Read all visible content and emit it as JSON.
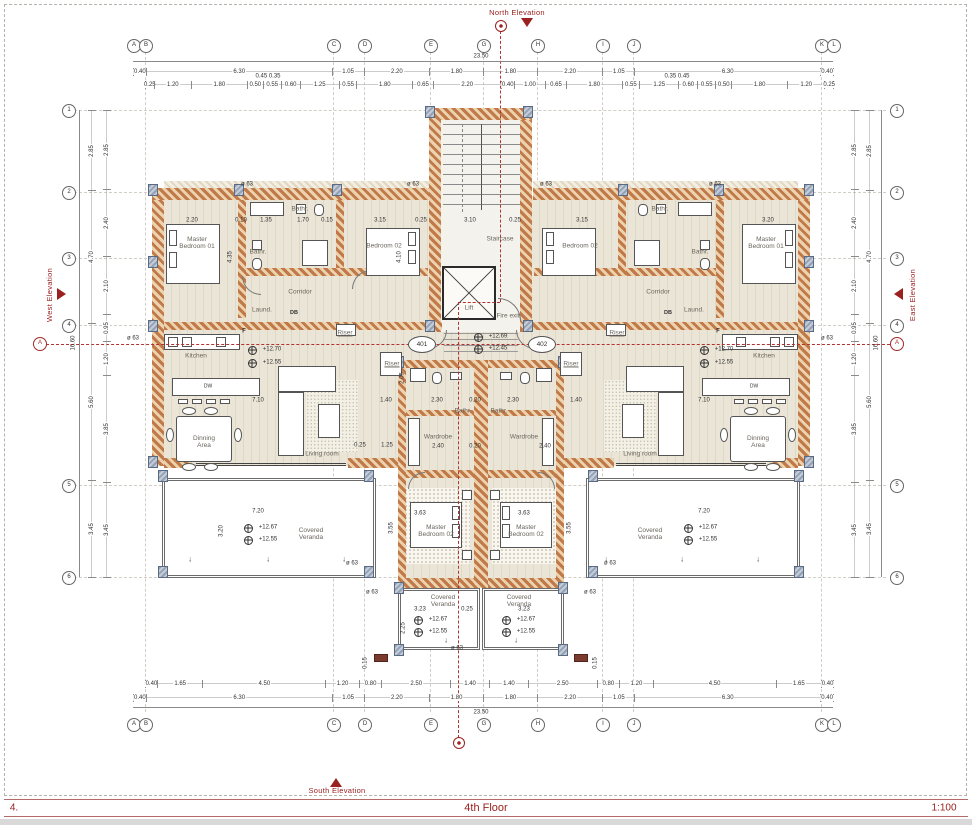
{
  "sheet": {
    "number": "4.",
    "title": "4th Floor",
    "scale": "1:100"
  },
  "elevations": {
    "north": "North Elevation",
    "south": "South Elevation",
    "east": "East Elevation",
    "west": "West Elevation"
  },
  "grid": {
    "cols": [
      "A",
      "B",
      "C",
      "D",
      "E",
      "G",
      "H",
      "I",
      "J",
      "K",
      "L"
    ],
    "rows": [
      "1",
      "2",
      "3",
      "4",
      "5",
      "6"
    ],
    "section_marker": "A"
  },
  "totals": {
    "width": "23.50",
    "height": "16.60"
  },
  "dim_rows": {
    "top_major": [
      "0.40",
      "6.30",
      "1.05",
      "2.20",
      "1.80",
      "1.80",
      "2.20",
      "1.05",
      "6.30",
      "0.40"
    ],
    "top_detail": [
      "0.25",
      "1.20",
      "1.80",
      "0.50",
      "0.55",
      "0.60",
      "1.25",
      "0.55",
      "1.80",
      "0.65",
      "2.20",
      "0.40",
      "1.00",
      "0.65",
      "1.80",
      "0.55",
      "1.25",
      "0.60",
      "0.55",
      "0.50",
      "1.80",
      "1.20",
      "0.25"
    ],
    "top_floaters": [
      "0.45 0.35",
      "0.35 0.45"
    ],
    "bottom_major": [
      "0.40",
      "6.30",
      "1.05",
      "2.20",
      "1.80",
      "1.80",
      "2.20",
      "1.05",
      "6.30",
      "0.40"
    ],
    "bottom_detail": [
      "0.40",
      "1.65",
      "4.50",
      "1.20",
      "0.80",
      "2.50",
      "1.40",
      "1.40",
      "2.50",
      "0.80",
      "1.20",
      "4.50",
      "1.65",
      "0.40"
    ],
    "left_outer": [
      "2.85",
      "4.70",
      "5.60",
      "3.45"
    ],
    "left_inner": [
      "2.85",
      "2.40",
      "2.10",
      "0.95",
      "1.20",
      "3.85",
      "3.45"
    ],
    "right_outer": [
      "2.85",
      "4.70",
      "5.60",
      "3.45"
    ],
    "right_inner": [
      "2.85",
      "2.40",
      "2.10",
      "0.95",
      "1.20",
      "3.85",
      "3.45"
    ]
  },
  "rooms": {
    "master1": "Master Bedroom 01",
    "master2": "Master Bedroom 02",
    "bedroom2": "Bedroom 02",
    "bath": "Bathr.",
    "corridor": "Corridor",
    "laundry": "Laund.",
    "kitchen": "Kitchen",
    "dining": "Dinning Area",
    "living": "Living room",
    "wardrobe": "Wardrobe",
    "veranda": "Covered Veranda",
    "stair": "Staircase",
    "lift": "Lift",
    "fire": "Fire exit",
    "riser": "Riser"
  },
  "units": [
    "401",
    "402"
  ],
  "levels": {
    "living_ffl": "+12.70",
    "living_sfl": "+12.55",
    "stair_ffl": "+12.69",
    "stair_sfl": "+12.45",
    "veranda_ffl": "+12.67",
    "veranda_sfl": "+12.55"
  },
  "pdims": [
    "2.20",
    "0.10",
    "1.35",
    "1.70",
    "0.15",
    "3.15",
    "0.25",
    "3.10",
    "0.25",
    "3.15",
    "3.20",
    "4.35",
    "4.10",
    "7.10",
    "1.40",
    "2.30",
    "0.20",
    "2.30",
    "1.40",
    "7.10",
    "2.05",
    "2.40",
    "2.40",
    "0.20",
    "7.20",
    "7.20",
    "3.20",
    "3.63",
    "3.63",
    "3.23",
    "0.25",
    "3.23",
    "2.25",
    "3.55",
    "3.55",
    "0.25",
    "1.25",
    "0.15",
    "0.15"
  ],
  "misc": {
    "db": "DB",
    "f": "F",
    "phi": "ø 63",
    "dw": "DW",
    "arrow": "↓"
  }
}
